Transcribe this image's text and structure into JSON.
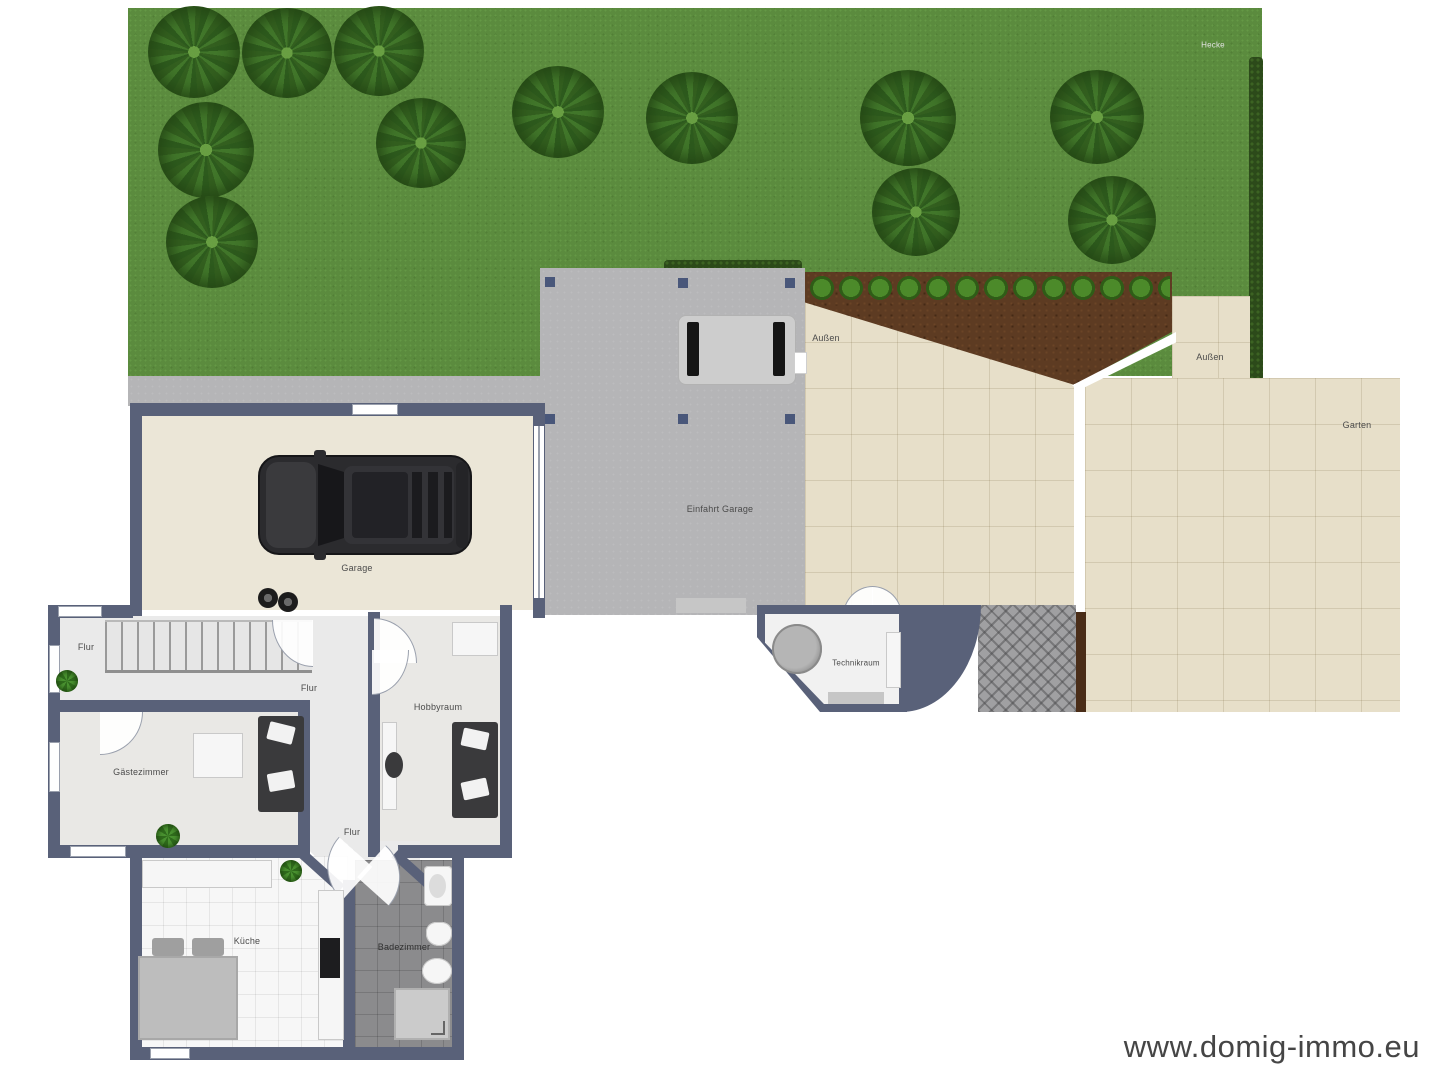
{
  "plan": {
    "labels": {
      "hecke": "Hecke",
      "aussen_left": "Außen",
      "aussen_right": "Außen",
      "garten": "Garten",
      "einfahrt_garage": "Einfahrt Garage",
      "garage": "Garage",
      "flur_upper": "Flur",
      "flur_mid": "Flur",
      "flur_lower": "Flur",
      "hobbyraum": "Hobbyraum",
      "gaestezimmer": "Gästezimmer",
      "kueche": "Küche",
      "badezimmer": "Badezimmer",
      "technikraum": "Technikraum"
    },
    "watermark": "www.domig-immo.eu",
    "colors": {
      "lawn": "#5b8b3e",
      "hedge": "#2c4a1a",
      "driveway": "#b5b5b7",
      "patio_tile": "#e7dfc9",
      "garden_bed_soil": "#5d3b22",
      "wall": "#596179",
      "garage_floor": "#ebe6d7",
      "hall_floor": "#eaeaea",
      "bath_tile": "#8b8b8d",
      "kitchen_tile": "#f7f7f7",
      "car_body": "#2b2b2e"
    }
  }
}
